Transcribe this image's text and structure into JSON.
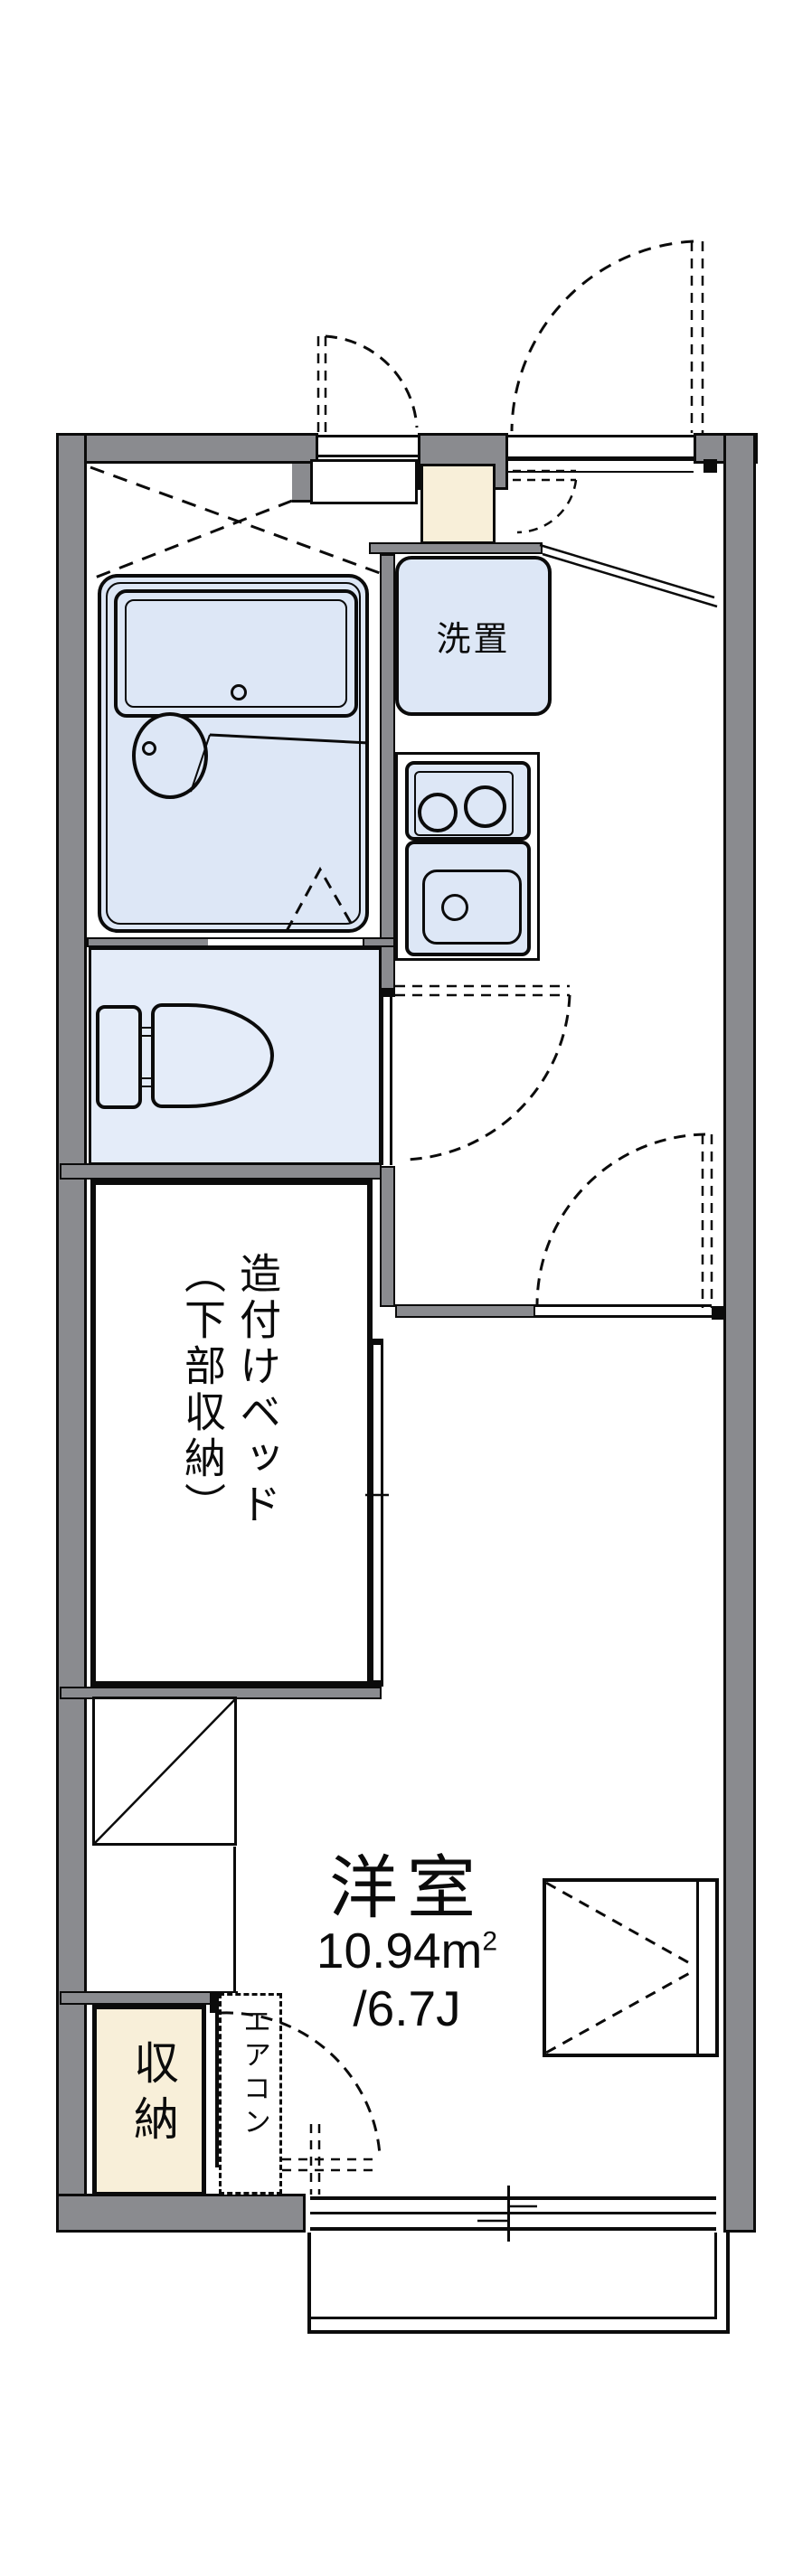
{
  "plan_title": "1K apartment floor plan",
  "labels": {
    "washer": "洗置",
    "bed_col1": "造付けベッド",
    "bed_col2": "（下部収納）",
    "room_name": "洋室",
    "room_area_value": "10.94m",
    "room_area_sup": "2",
    "room_area_jo": "/6.7J",
    "closet": "収納",
    "aircon": "エアコン"
  },
  "rooms": [
    {
      "name": "洋室",
      "area_m2": "10.94",
      "area_jo": "6.7J"
    },
    {
      "name": "収納"
    },
    {
      "name": "洗置"
    },
    {
      "name": "造付けベッド（下部収納）"
    }
  ],
  "colors": {
    "wall": "#8a8b8f",
    "line": "#0b0b0b",
    "floor_blue": "#e4ecf9",
    "fixture_blue": "#dde7f6",
    "genkan_beige": "#f8efd9",
    "background": "#ffffff"
  }
}
